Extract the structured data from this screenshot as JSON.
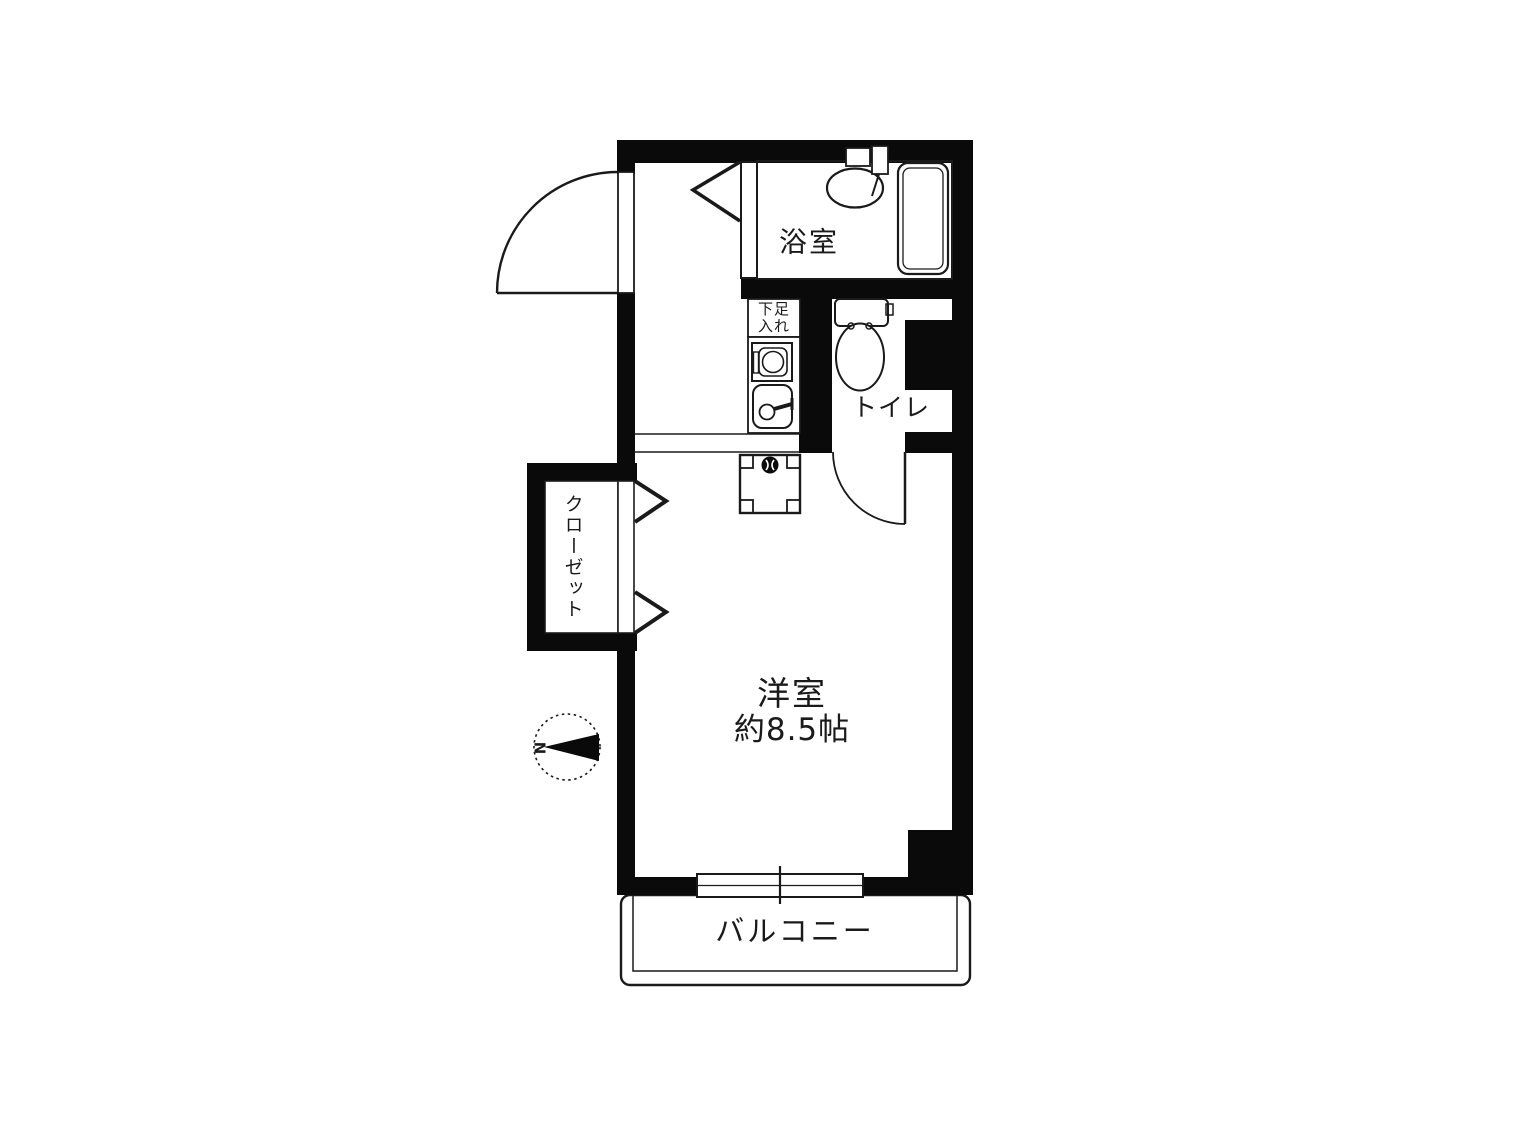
{
  "labels": {
    "bathroom": "浴室",
    "toilet": "トイレ",
    "closet": "クローゼット",
    "main_room": "洋室",
    "main_room_size": "約8.5帖",
    "balcony": "バルコニー",
    "shoe_cabinet": "下足入れ",
    "shoe_cabinet_line1": "下足",
    "shoe_cabinet_line2": "入れ",
    "compass_north": "N"
  },
  "colors": {
    "wall": "#0a0a0a",
    "line": "#1a1a1a",
    "background": "#ffffff"
  }
}
